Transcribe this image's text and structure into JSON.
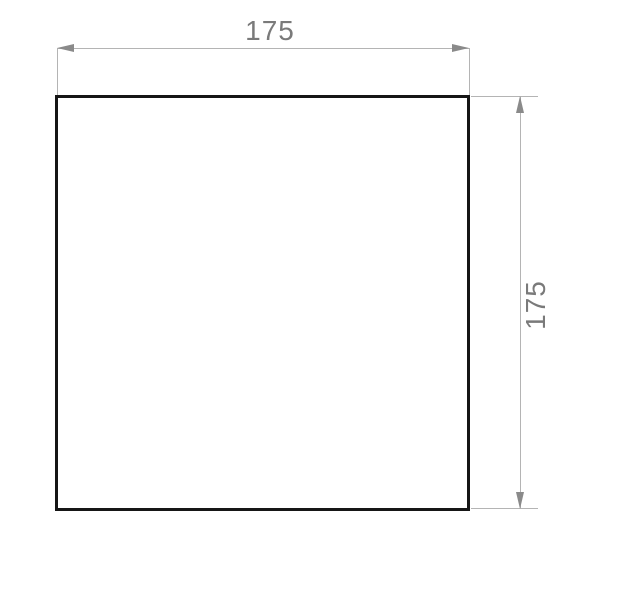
{
  "drawing": {
    "dimensions": {
      "top": {
        "value": "175"
      },
      "right": {
        "value": "175"
      }
    }
  },
  "colors": {
    "background": "#ffffff",
    "outline": "#161616",
    "dim-line": "#b4b4b4",
    "arrow": "#8a8a8a",
    "label": "#7a7a7a"
  }
}
